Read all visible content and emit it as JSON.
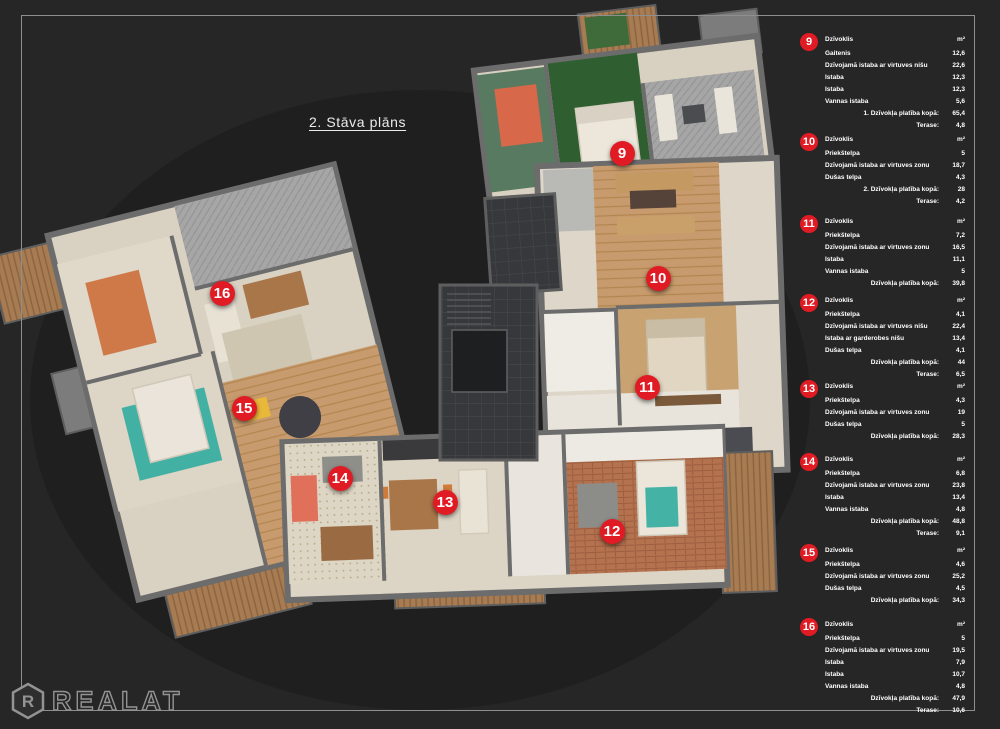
{
  "page": {
    "title": "2. Stāva plāns"
  },
  "logo": {
    "letter": "R",
    "text": "REALAT"
  },
  "colors": {
    "marker_red": "#e01b24",
    "background": "#262626",
    "frame_line": "#8f8f8f",
    "text_white": "#ffffff"
  },
  "apartments": [
    {
      "num": "9",
      "panel_top": 33,
      "plan_marker": {
        "x": 622,
        "y": 153
      },
      "header_label": "Dzīvoklis",
      "header_unit": "m²",
      "rows": [
        {
          "label": "Gaitenis",
          "value": "12,6",
          "total": false
        },
        {
          "label": "Dzīvojamā istaba ar virtuves nišu",
          "value": "22,6",
          "total": false
        },
        {
          "label": "Istaba",
          "value": "12,3",
          "total": false
        },
        {
          "label": "Istaba",
          "value": "12,3",
          "total": false
        },
        {
          "label": "Vannas istaba",
          "value": "5,6",
          "total": false
        },
        {
          "label": "1. Dzīvokļa platība kopā:",
          "value": "65,4",
          "total": true
        },
        {
          "label": "Terase:",
          "value": "4,8",
          "total": true
        }
      ]
    },
    {
      "num": "10",
      "panel_top": 133,
      "plan_marker": {
        "x": 658,
        "y": 278
      },
      "header_label": "Dzīvoklis",
      "header_unit": "m²",
      "rows": [
        {
          "label": "Priekštelpa",
          "value": "5",
          "total": false
        },
        {
          "label": "Dzīvojamā istaba ar virtuves zonu",
          "value": "18,7",
          "total": false
        },
        {
          "label": "Dušas telpa",
          "value": "4,3",
          "total": false
        },
        {
          "label": "2. Dzīvokļa platība kopā:",
          "value": "28",
          "total": true
        },
        {
          "label": "Terase:",
          "value": "4,2",
          "total": true
        }
      ]
    },
    {
      "num": "11",
      "panel_top": 215,
      "plan_marker": {
        "x": 647,
        "y": 387
      },
      "header_label": "Dzīvoklis",
      "header_unit": "m²",
      "rows": [
        {
          "label": "Priekštelpa",
          "value": "7,2",
          "total": false
        },
        {
          "label": "Dzīvojamā istaba ar virtuves zonu",
          "value": "16,5",
          "total": false
        },
        {
          "label": "Istaba",
          "value": "11,1",
          "total": false
        },
        {
          "label": "Vannas istaba",
          "value": "5",
          "total": false
        },
        {
          "label": "Dzīvokļa platība kopā:",
          "value": "39,8",
          "total": true
        }
      ]
    },
    {
      "num": "12",
      "panel_top": 294,
      "plan_marker": {
        "x": 612,
        "y": 531
      },
      "header_label": "Dzīvoklis",
      "header_unit": "m²",
      "rows": [
        {
          "label": "Priekštelpa",
          "value": "4,1",
          "total": false
        },
        {
          "label": "Dzīvojamā istaba ar virtuves nišu",
          "value": "22,4",
          "total": false
        },
        {
          "label": "Istaba ar garderobes nišu",
          "value": "13,4",
          "total": false
        },
        {
          "label": "Dušas telpa",
          "value": "4,1",
          "total": false
        },
        {
          "label": "Dzīvokļa platība kopā:",
          "value": "44",
          "total": true
        },
        {
          "label": "Terase:",
          "value": "6,5",
          "total": true
        }
      ]
    },
    {
      "num": "13",
      "panel_top": 380,
      "plan_marker": {
        "x": 445,
        "y": 502
      },
      "header_label": "Dzīvoklis",
      "header_unit": "m²",
      "rows": [
        {
          "label": "Priekštelpa",
          "value": "4,3",
          "total": false
        },
        {
          "label": "Dzīvojamā istaba ar virtuves zonu",
          "value": "19",
          "total": false
        },
        {
          "label": "Dušas telpa",
          "value": "5",
          "total": false
        },
        {
          "label": "Dzīvokļa platība kopā:",
          "value": "28,3",
          "total": true
        }
      ]
    },
    {
      "num": "14",
      "panel_top": 453,
      "plan_marker": {
        "x": 340,
        "y": 478
      },
      "header_label": "Dzīvoklis",
      "header_unit": "m²",
      "rows": [
        {
          "label": "Priekštelpa",
          "value": "6,8",
          "total": false
        },
        {
          "label": "Dzīvojamā istaba ar virtuves zonu",
          "value": "23,8",
          "total": false
        },
        {
          "label": "Istaba",
          "value": "13,4",
          "total": false
        },
        {
          "label": "Vannas istaba",
          "value": "4,8",
          "total": false
        },
        {
          "label": "Dzīvokļa platība kopā:",
          "value": "48,8",
          "total": true
        },
        {
          "label": "Terase:",
          "value": "9,1",
          "total": true
        }
      ]
    },
    {
      "num": "15",
      "panel_top": 544,
      "plan_marker": {
        "x": 244,
        "y": 408
      },
      "header_label": "Dzīvoklis",
      "header_unit": "m²",
      "rows": [
        {
          "label": "Priekštelpa",
          "value": "4,6",
          "total": false
        },
        {
          "label": "Dzīvojamā istaba ar virtuves zonu",
          "value": "25,2",
          "total": false
        },
        {
          "label": "Dušas telpa",
          "value": "4,5",
          "total": false
        },
        {
          "label": "Dzīvokļa platība kopā:",
          "value": "34,3",
          "total": true
        }
      ]
    },
    {
      "num": "16",
      "panel_top": 618,
      "plan_marker": {
        "x": 222,
        "y": 293
      },
      "header_label": "Dzīvoklis",
      "header_unit": "m²",
      "rows": [
        {
          "label": "Priekštelpa",
          "value": "5",
          "total": false
        },
        {
          "label": "Dzīvojamā istaba ar virtuves zonu",
          "value": "19,5",
          "total": false
        },
        {
          "label": "Istaba",
          "value": "7,9",
          "total": false
        },
        {
          "label": "Istaba",
          "value": "10,7",
          "total": false
        },
        {
          "label": "Vannas istaba",
          "value": "4,8",
          "total": false
        },
        {
          "label": "Dzīvokļa platība kopā:",
          "value": "47,9",
          "total": true
        },
        {
          "label": "Terase:",
          "value": "10,6",
          "total": true
        }
      ]
    }
  ]
}
